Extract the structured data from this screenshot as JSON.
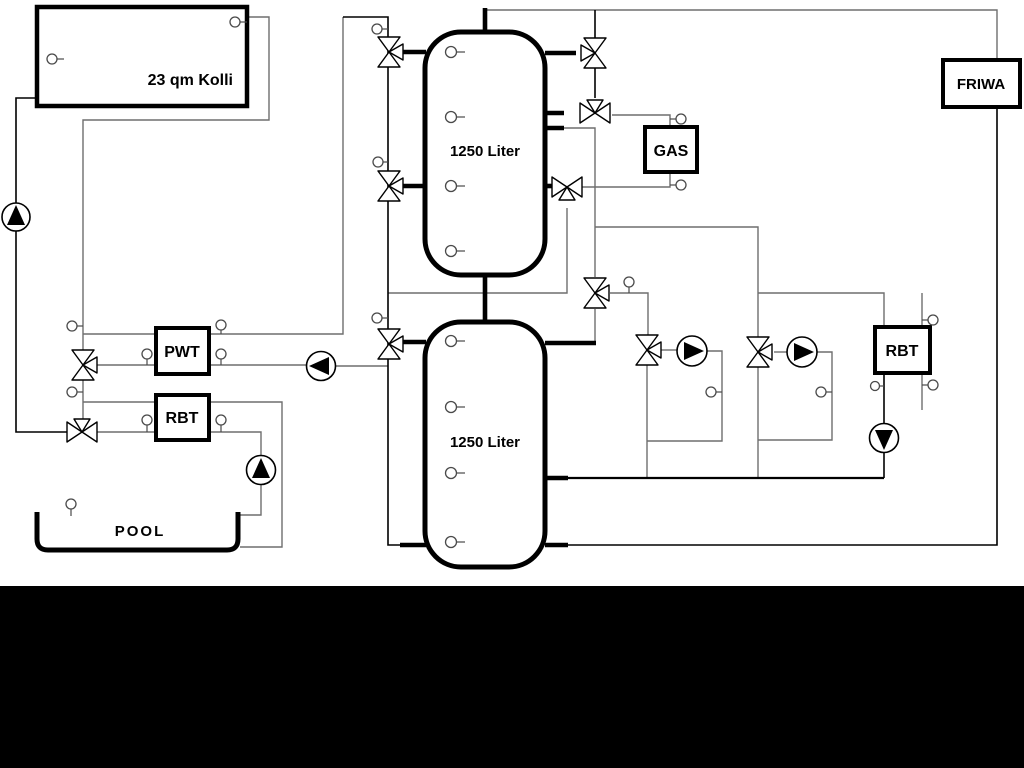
{
  "diagram": {
    "type": "hydraulic-schematic",
    "background_color": "#ffffff",
    "pipe_gray_color": "#6e6e6e",
    "pipe_black_color": "#000000",
    "bottom_band_color": "#000000",
    "labels": {
      "collector": "23 qm Kolli",
      "tank1": "1250 Liter",
      "tank2": "1250 Liter",
      "pwt": "PWT",
      "rbt_left": "RBT",
      "pool": "POOL",
      "gas": "GAS",
      "rbt_right": "RBT",
      "friwa": "FRIWA"
    },
    "equipment": {
      "pumps": [
        {
          "name": "solar-pump",
          "direction": "up"
        },
        {
          "name": "pwt-pump",
          "direction": "left"
        },
        {
          "name": "pool-pump",
          "direction": "up"
        },
        {
          "name": "heating-circuit-1-pump",
          "direction": "right"
        },
        {
          "name": "heating-circuit-2-pump",
          "direction": "right"
        },
        {
          "name": "rbt-right-pump",
          "direction": "down"
        }
      ],
      "valves": [
        {
          "name": "tank1-left-top-valve",
          "type": "three-way"
        },
        {
          "name": "tank1-left-mid-valve",
          "type": "three-way"
        },
        {
          "name": "tank2-left-valve",
          "type": "three-way"
        },
        {
          "name": "pwt-valve",
          "type": "three-way"
        },
        {
          "name": "rbt-left-valve",
          "type": "three-way"
        },
        {
          "name": "tank1-right-top-valve",
          "type": "three-way"
        },
        {
          "name": "gas-supply-valve",
          "type": "three-way"
        },
        {
          "name": "gas-return-valve",
          "type": "three-way"
        },
        {
          "name": "mixing-valve",
          "type": "three-way"
        },
        {
          "name": "heating-circuit-1-valve",
          "type": "three-way"
        },
        {
          "name": "heating-circuit-2-valve",
          "type": "three-way"
        }
      ],
      "sensor_count": 27
    }
  }
}
